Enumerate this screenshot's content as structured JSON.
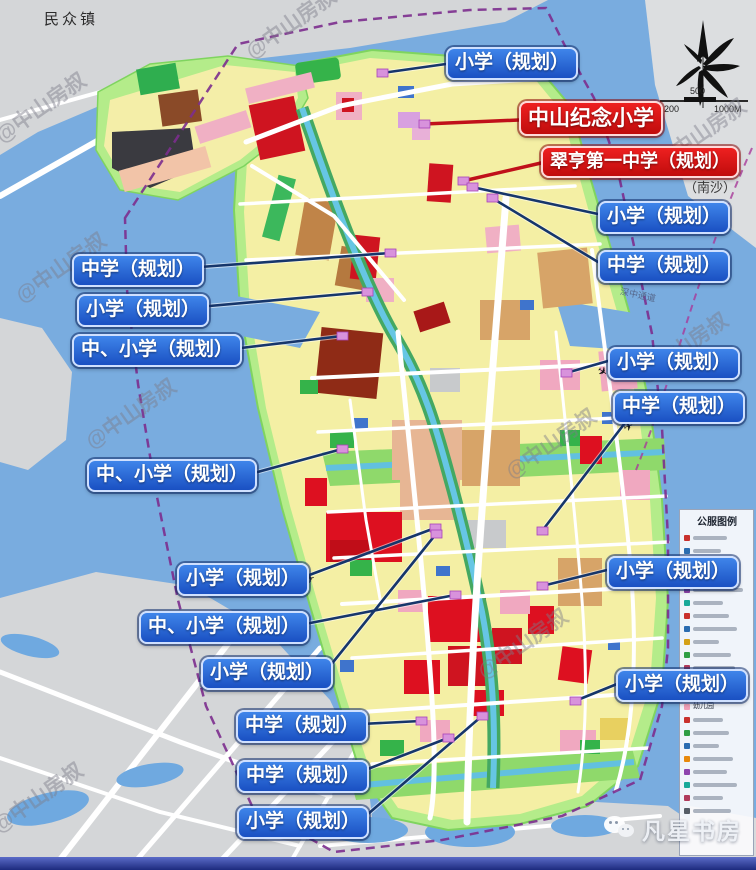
{
  "map_texts": {
    "town": "民众镇",
    "nansha": "（南沙）",
    "corridor": "深中通道"
  },
  "labels": [
    {
      "id": "xiaoxue-top",
      "text": "小学（规划）",
      "type": "blue"
    },
    {
      "id": "zhongshan-jinian-xiaoxue",
      "text": "中山纪念小学",
      "type": "red"
    },
    {
      "id": "cuiheng-diyi-zhongxue",
      "text": "翠亨第一中学（规划）",
      "type": "red"
    },
    {
      "id": "xiaoxue-r1",
      "text": "小学（规划）",
      "type": "blue"
    },
    {
      "id": "zhongxue-r1",
      "text": "中学（规划）",
      "type": "blue"
    },
    {
      "id": "zhongxue-l1",
      "text": "中学（规划）",
      "type": "blue"
    },
    {
      "id": "xiaoxue-l1",
      "text": "小学（规划）",
      "type": "blue"
    },
    {
      "id": "zhong-xiaoxue-l1",
      "text": "中、小学（规划）",
      "type": "blue"
    },
    {
      "id": "xiaoxue-r2",
      "text": "小学（规划）",
      "type": "blue"
    },
    {
      "id": "zhongxue-r2",
      "text": "中学（规划）",
      "type": "blue"
    },
    {
      "id": "zhong-xiaoxue-l2",
      "text": "中、小学（规划）",
      "type": "blue"
    },
    {
      "id": "xiaoxue-m1",
      "text": "小学（规划）",
      "type": "blue"
    },
    {
      "id": "xiaoxue-r3",
      "text": "小学（规划）",
      "type": "blue"
    },
    {
      "id": "zhong-xiaoxue-m",
      "text": "中、小学（规划）",
      "type": "blue"
    },
    {
      "id": "xiaoxue-m2",
      "text": "小学（规划）",
      "type": "blue"
    },
    {
      "id": "xiaoxue-r4",
      "text": "小学（规划）",
      "type": "blue"
    },
    {
      "id": "zhongxue-b1",
      "text": "中学（规划）",
      "type": "blue"
    },
    {
      "id": "zhongxue-b2",
      "text": "中学（规划）",
      "type": "blue"
    },
    {
      "id": "xiaoxue-b",
      "text": "小学（规划）",
      "type": "blue"
    }
  ],
  "legend": {
    "title": "公服图例",
    "readable_items": {
      "middle_school": "中学",
      "primary_school": "小学",
      "kindergarten": "幼儿园"
    }
  },
  "scale_bar": {
    "upper": "500",
    "lower_left": "200",
    "lower_right": "1000M"
  },
  "watermarks": {
    "diagonal": "@中山房叔",
    "badge": "凡星书房"
  },
  "icons": {
    "plane": "✈"
  },
  "colors": {
    "label_blue": "#1e56c8",
    "label_red": "#d61212",
    "water": "#79acdf",
    "land_gray": "#d5d7d9",
    "greenbelt": "#b4ec8a",
    "parcel_yellow": "#f4efa4",
    "parcel_red": "#d8101c",
    "parcel_tan": "#d7a468",
    "parcel_pink": "#efaabf",
    "parcel_green": "#35b34a",
    "boundary_dash": "#7c2d8e"
  }
}
